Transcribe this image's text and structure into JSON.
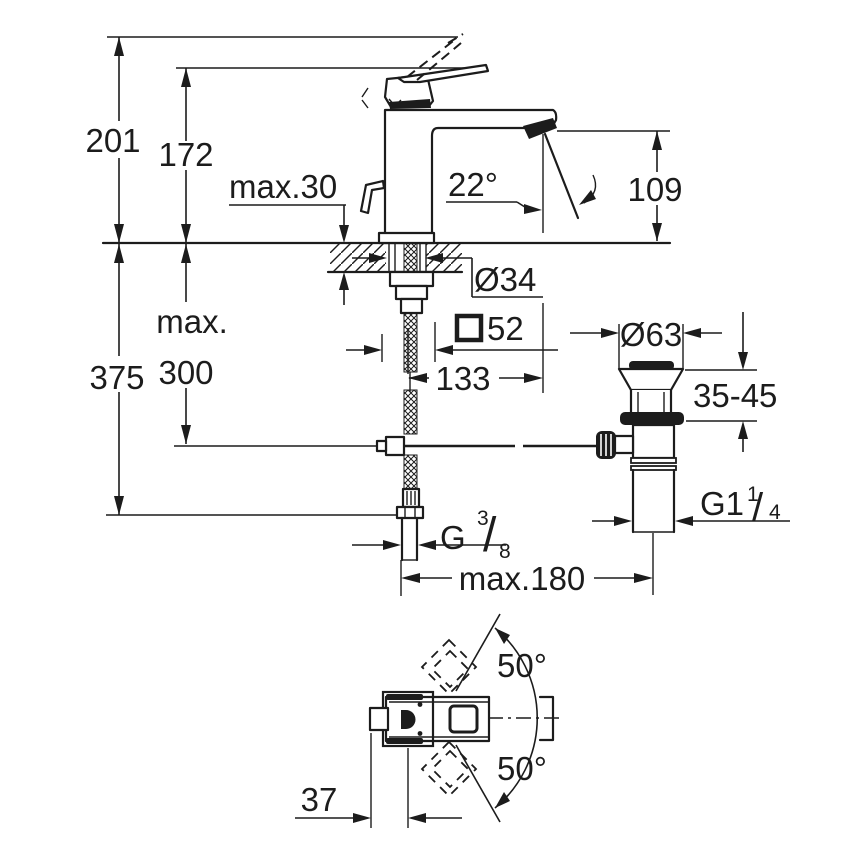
{
  "colors": {
    "line": "#1c1c1c",
    "background": "#ffffff"
  },
  "front_view": {
    "overall_height": "201",
    "body_height": "172",
    "max_deck_thickness": "max.30",
    "stream_angle": "22°",
    "spout_outlet_height": "109",
    "mounting_hole_diameter": "Ø34",
    "base_square_size": "52",
    "spout_reach": "133",
    "hose_length_label": "max.",
    "hose_length_value": "300",
    "overall_install_height": "375",
    "supply_thread": {
      "prefix": "G",
      "numerator": "3",
      "slash": "/",
      "denominator": "8"
    },
    "max_drain_spacing": "max.180"
  },
  "drain_assembly": {
    "flange_diameter": "Ø63",
    "clamping_range": "35-45",
    "waste_thread": {
      "prefix": "G1",
      "numerator": "1",
      "slash": "/",
      "denominator": "4"
    }
  },
  "plan_view": {
    "handle_swing_upper": "50°",
    "handle_swing_lower": "50°",
    "handle_projection": "37"
  }
}
